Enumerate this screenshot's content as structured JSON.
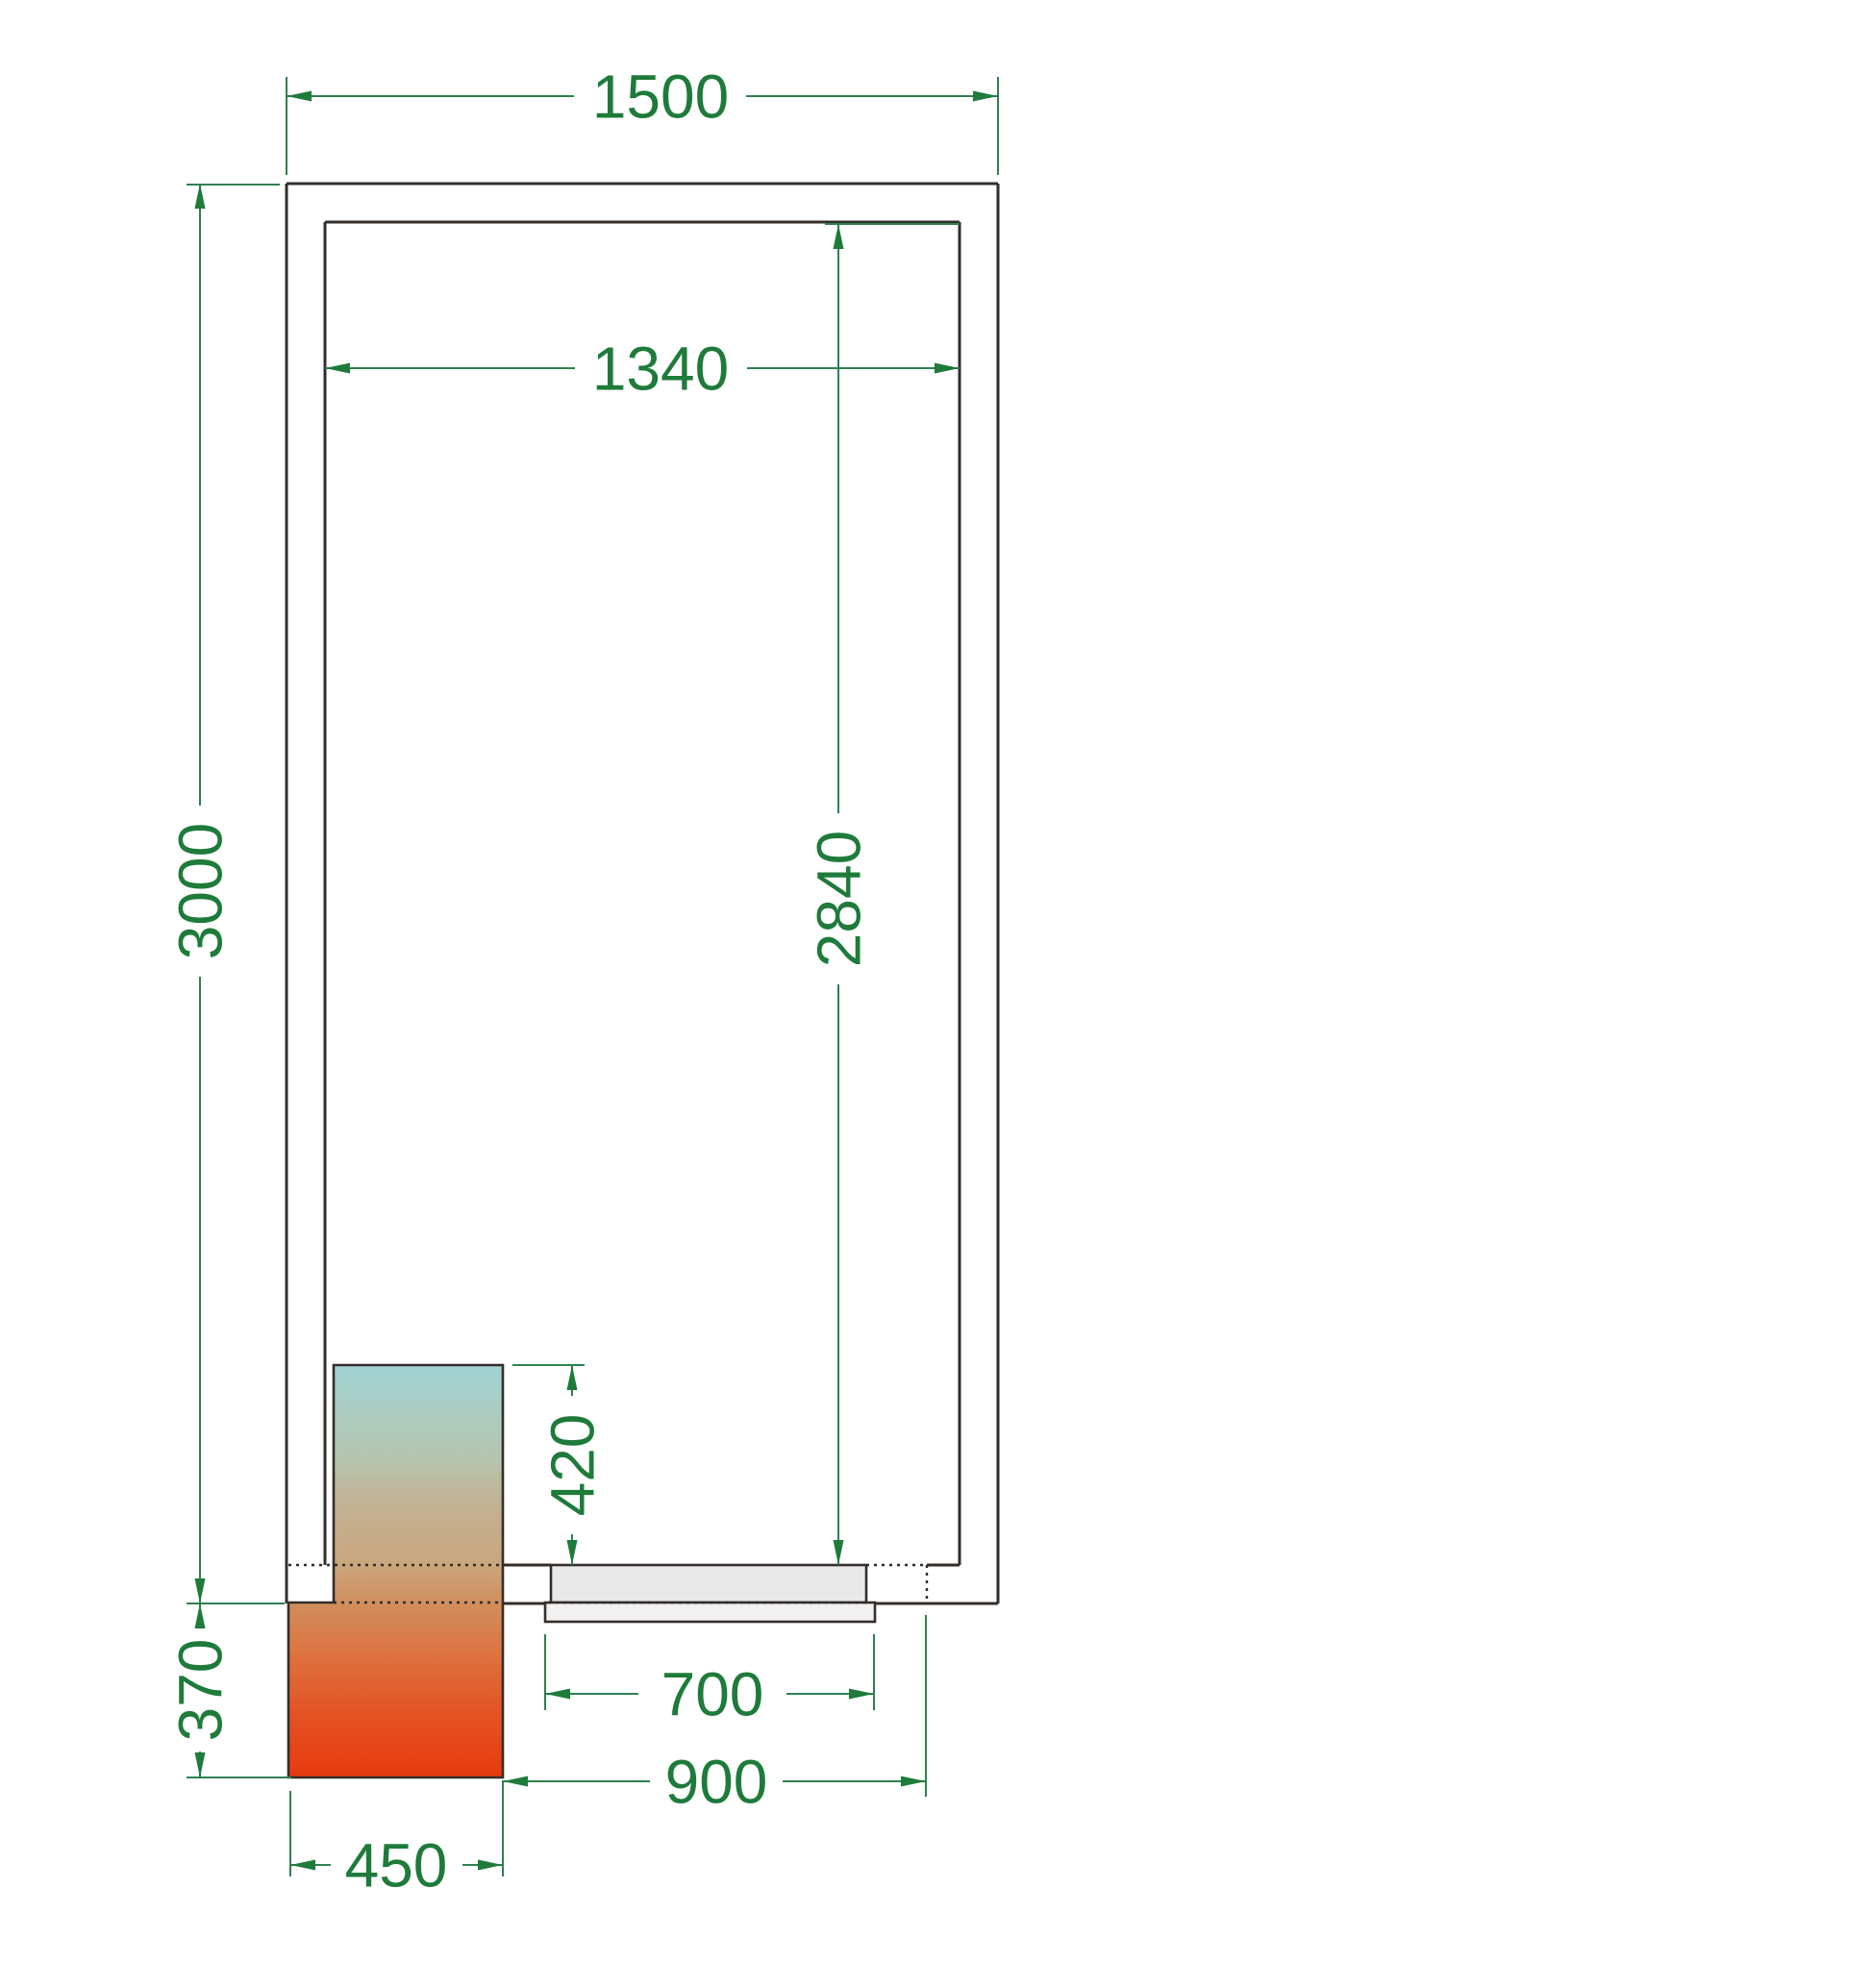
{
  "drawing": {
    "kind": "cold-room floor plan, top view, technical CAD drawing",
    "units": "mm",
    "entities": {
      "outer_wall": "rectangular panel wall, outer contour",
      "inner_wall": "room inner contour",
      "cooling_unit": "refrigeration unit block with thermal gradient fill, protruding through rear wall",
      "door": "sliding door leaf shown in wall opening, grey fill",
      "hidden_edges": "dotted lines marking wall faces through the unit and door opening"
    }
  },
  "colors": {
    "background": "#ffffff",
    "wall_line": "#332e2a",
    "dimension_text": "#1e7b3a",
    "dimension_line": "#2e8050",
    "door_leaf_fill": "#e9e9ea",
    "door_outer_fill": "#f1f1f1",
    "unit_gradient_top": "#a0d2d3",
    "unit_gradient_sage": "#b6c5ae",
    "unit_gradient_tan": "#c2b295",
    "unit_gradient_sand": "#c9a77e",
    "unit_gradient_amber": "#d0905f",
    "unit_gradient_orange": "#dd7340",
    "unit_gradient_deep_orange": "#e35627",
    "unit_gradient_red": "#e73a0e"
  },
  "dimensions": {
    "outer_width": {
      "label": "1500",
      "value_mm": 1500,
      "orientation": "horizontal"
    },
    "inner_width": {
      "label": "1340",
      "value_mm": 1340,
      "orientation": "horizontal"
    },
    "outer_depth": {
      "label": "3000",
      "value_mm": 3000,
      "orientation": "vertical"
    },
    "inner_depth": {
      "label": "2840",
      "value_mm": 2840,
      "orientation": "vertical"
    },
    "unit_inside": {
      "label": "420",
      "value_mm": 420,
      "orientation": "vertical"
    },
    "unit_outside": {
      "label": "370",
      "value_mm": 370,
      "orientation": "vertical"
    },
    "door_leaf": {
      "label": "700",
      "value_mm": 700,
      "orientation": "horizontal"
    },
    "door_frame": {
      "label": "900",
      "value_mm": 900,
      "orientation": "horizontal"
    },
    "unit_width": {
      "label": "450",
      "value_mm": 450,
      "orientation": "horizontal"
    }
  }
}
